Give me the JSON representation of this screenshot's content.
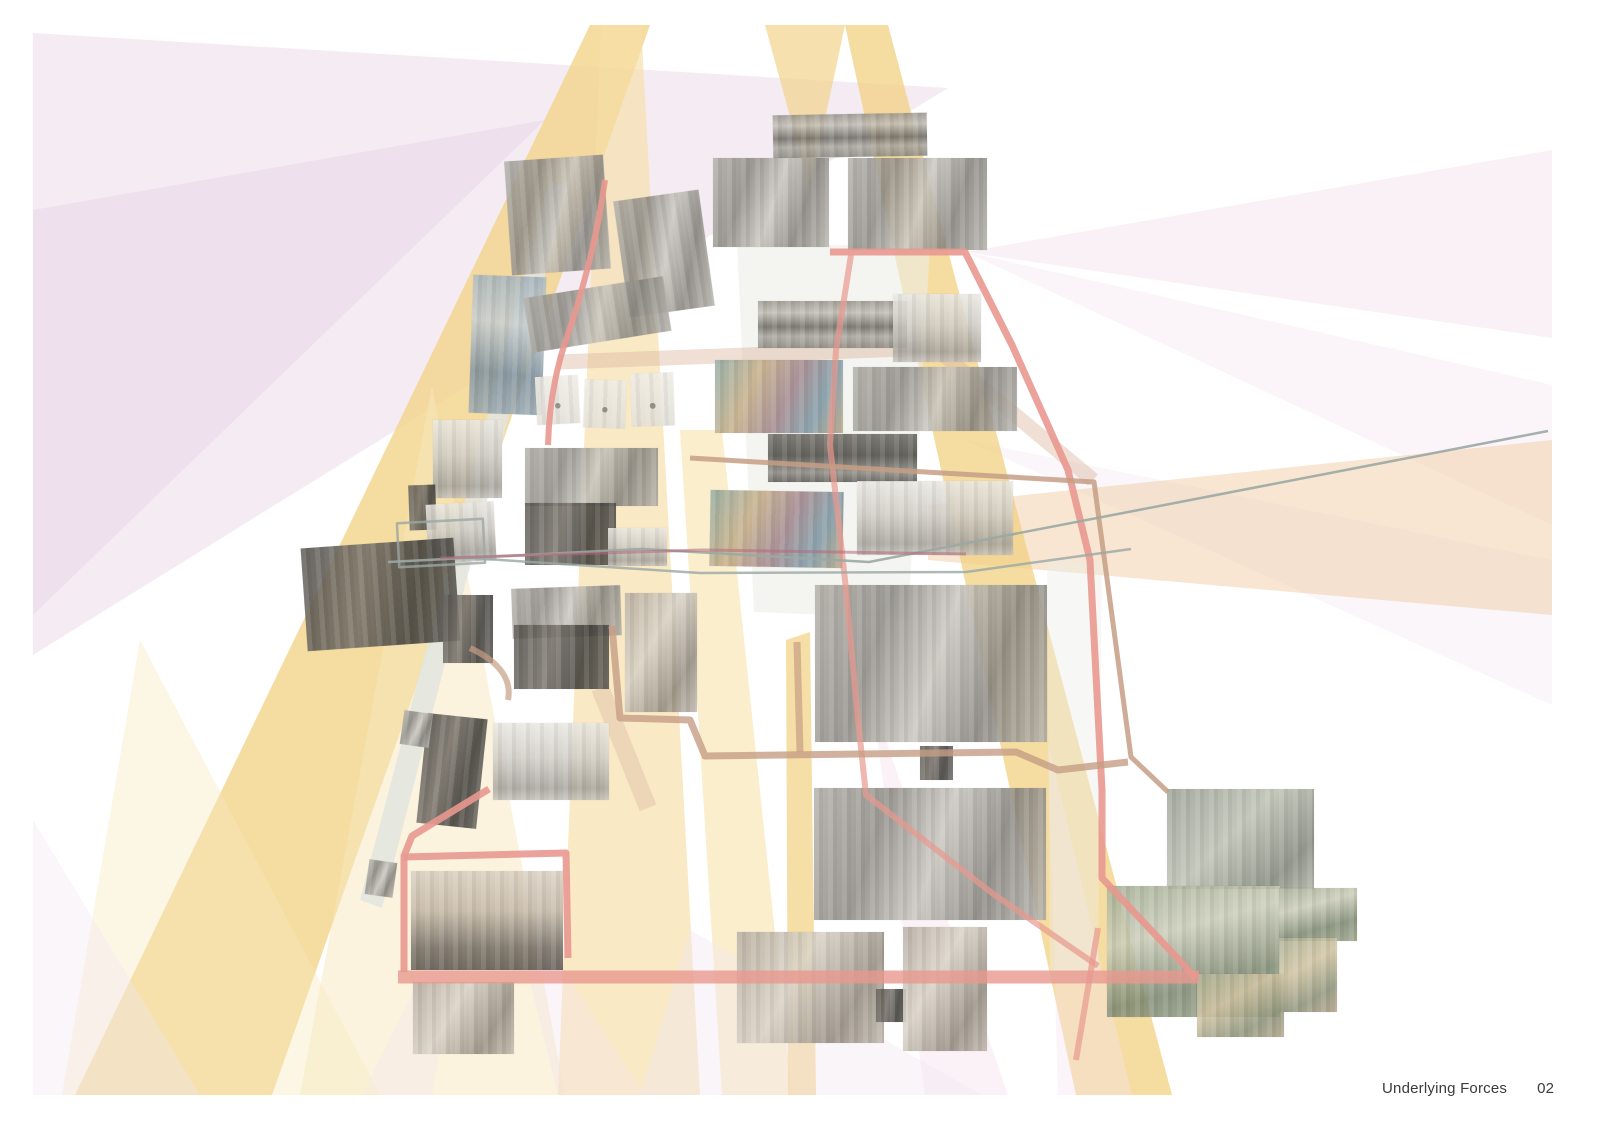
{
  "page": {
    "title": "Underlying Forces",
    "page_number": "02"
  },
  "palette": {
    "salmon_line": "#E8988F",
    "tan_line": "#C69E85",
    "tan_ribbon": "#DCB9A2",
    "gray_line": "#9AA8A4",
    "maroon_line": "#B4687A",
    "beam_yellow": "#F2D38A",
    "beam_yellow_deep": "#F2D082",
    "beam_yellow_soft": "#F6DFA6",
    "beam_yellow_mid": "#F6E2AC",
    "beam_yellow_pale": "#F8E8BD",
    "lavender": "#ECDCEA",
    "lavender_deep": "#E3CFE3",
    "pink": "#F4E3ED",
    "pink_soft": "#F2E6F0",
    "peach": "#F0C79B",
    "ribbon_gray": "#E2E5DF",
    "column_gray": "#ECEEE8",
    "text": "#3B3B3B"
  },
  "photos": [
    {
      "id": "pano-coast-1",
      "desc": "panoramic coastline and city skyline"
    },
    {
      "id": "playground-outdoor",
      "desc": "children playing on an outdoor playground"
    },
    {
      "id": "kids-playroom",
      "desc": "children climbing in an indoor playroom"
    },
    {
      "id": "pano-coast-2",
      "desc": "panoramic coastline view"
    },
    {
      "id": "trainer-stretch",
      "desc": "trainer assisting a client stretching"
    },
    {
      "id": "play-structure",
      "desc": "indoor play structure with tubes"
    },
    {
      "id": "exercise-bikes",
      "desc": "fitness assessment on exercise bikes"
    },
    {
      "id": "pano-coast-3",
      "desc": "dark panoramic seascape"
    },
    {
      "id": "play-structure-2",
      "desc": "colorful indoor playground equipment"
    },
    {
      "id": "gym-hall",
      "desc": "historic gymnasium with checkered floor"
    },
    {
      "id": "waterpark",
      "desc": "indoor waterpark with slides and pools"
    },
    {
      "id": "thumb-dark-a",
      "desc": "small dark thumbnail"
    },
    {
      "id": "swim-arena",
      "desc": "olympic swimming pool arena"
    },
    {
      "id": "forest-rocks",
      "desc": "forest path over rocks"
    },
    {
      "id": "outdoor-gym",
      "desc": "outdoor gymnastics equipment"
    },
    {
      "id": "sports-court",
      "desc": "athletes on a sports court"
    },
    {
      "id": "tilted-classroom",
      "desc": "tilted photo of a classroom"
    },
    {
      "id": "figure-sketch-1",
      "desc": "small figure study"
    },
    {
      "id": "figure-sketch-2",
      "desc": "small figure study"
    },
    {
      "id": "figure-sketch-3",
      "desc": "small figure study"
    },
    {
      "id": "weight-room",
      "desc": "weight training room"
    },
    {
      "id": "thumb-dark-b",
      "desc": "small dark thumbnail"
    },
    {
      "id": "judo-practice",
      "desc": "martial arts practice"
    },
    {
      "id": "volleyball-court",
      "desc": "volleyball game in a gym"
    },
    {
      "id": "boxing-ring",
      "desc": "boxing ring under spotlights"
    },
    {
      "id": "pilates-class",
      "desc": "mat exercise class in a bright room"
    },
    {
      "id": "concert-hall",
      "desc": "audience in a dark concert hall"
    },
    {
      "id": "stage-side",
      "desc": "dark backstage scene"
    },
    {
      "id": "gym-class",
      "desc": "group exercise class"
    },
    {
      "id": "dance-dark",
      "desc": "dancers rehearsing on a dark stage"
    },
    {
      "id": "wall-texture",
      "desc": "striped concrete wall texture"
    },
    {
      "id": "arcade-bar",
      "desc": "arcade bar interior"
    },
    {
      "id": "dance-studio",
      "desc": "dance rehearsal in a bright studio"
    },
    {
      "id": "ribbon-chip-a",
      "desc": "small photo chip"
    },
    {
      "id": "ribbon-chip-b",
      "desc": "small photo chip"
    },
    {
      "id": "rooftop-cinema",
      "desc": "rooftop open-air cinema at dusk"
    },
    {
      "id": "street-market",
      "desc": "evening street market"
    },
    {
      "id": "spa-room",
      "desc": "spa treatment room"
    },
    {
      "id": "thumb-dark-c",
      "desc": "small dark thumbnail"
    },
    {
      "id": "sauna",
      "desc": "woman resting in a sauna"
    },
    {
      "id": "bee-colony",
      "desc": "bees on a honeycomb"
    },
    {
      "id": "city-green-roof",
      "desc": "green roof garden among skyscrapers"
    },
    {
      "id": "dragonfly",
      "desc": "dragonfly on a branch"
    },
    {
      "id": "ladybug",
      "desc": "ladybug on a leaf"
    },
    {
      "id": "butterfly",
      "desc": "monarch butterfly in grass"
    }
  ]
}
